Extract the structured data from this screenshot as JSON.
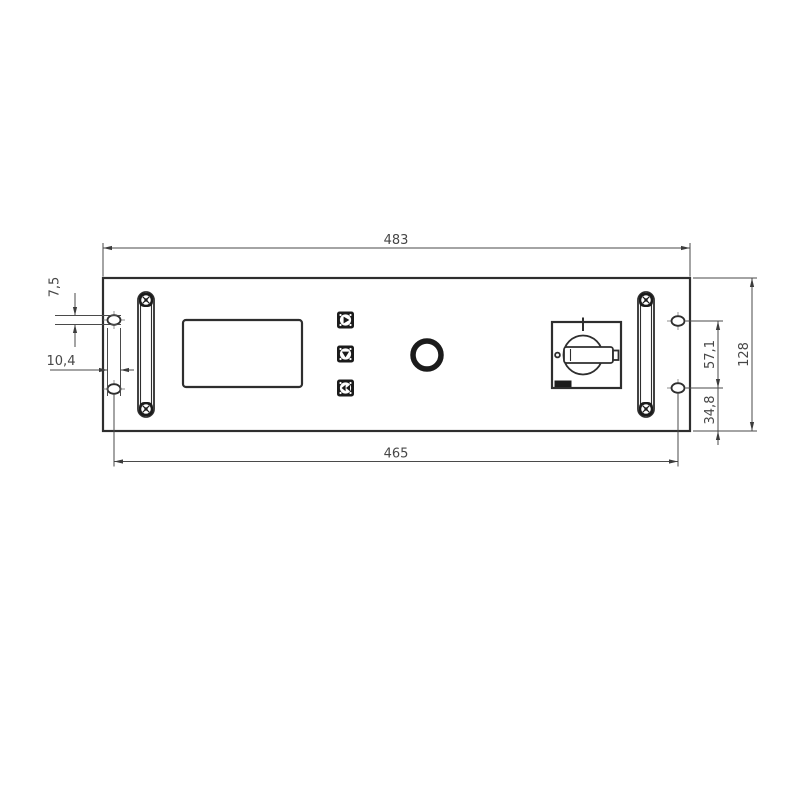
{
  "drawing": {
    "type": "technical-drawing-front-panel",
    "dimensions": {
      "overall_width": "483",
      "mounting_hole_span": "465",
      "overall_height": "128",
      "hole_vertical_spacing": "57,1",
      "hole_to_bottom_edge": "34,8",
      "slot_height": "7,5",
      "slot_width": "10,4"
    },
    "icons": {
      "button_top": "play-icon",
      "button_middle": "down-arrow-icon",
      "button_bottom": "rewind-icon"
    },
    "colors": {
      "line": "#2e2e2e",
      "dimension_line": "#4a4a4a",
      "dark_fill": "#1b1b1b",
      "background": "#ffffff"
    }
  }
}
